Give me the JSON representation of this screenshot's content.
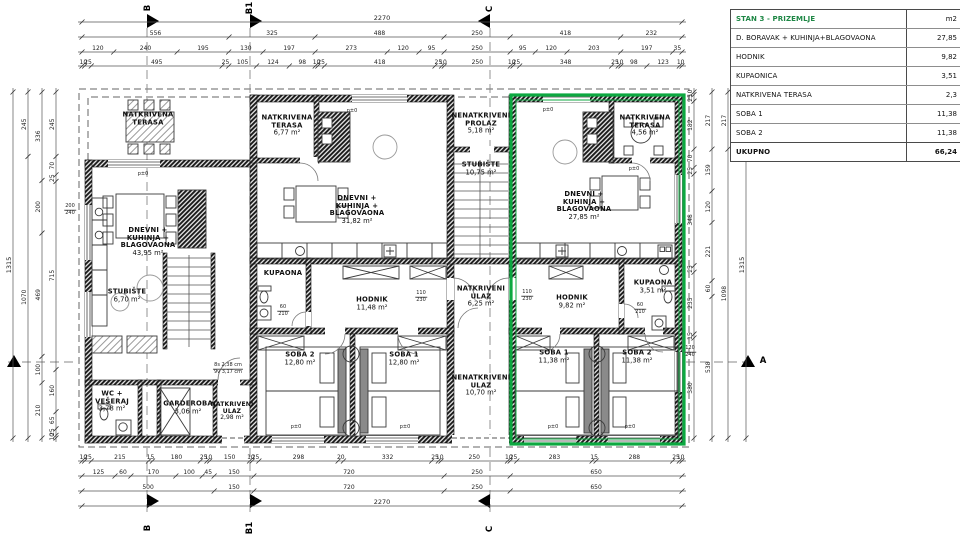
{
  "colors": {
    "highlight_green": "#0ca840",
    "table_title_green": "#1e8745",
    "wall": "#1c1c1c",
    "dim_line": "#555555"
  },
  "table": {
    "title": "STAN 3 - PRIZEMLJE",
    "unit_header": "m2",
    "rows": [
      {
        "label": "D. BORAVAK + KUHINJA+BLAGOVAONA",
        "value": "27,85"
      },
      {
        "label": "HODNIK",
        "value": "9,82"
      },
      {
        "label": "KUPAONICA",
        "value": "3,51"
      },
      {
        "label": "NATKRIVENA TERASA",
        "value": "2,3"
      },
      {
        "label": "SOBA 1",
        "value": "11,38"
      },
      {
        "label": "SOBA 2",
        "value": "11,38"
      }
    ],
    "total": {
      "label": "UKUPNO",
      "value": "66,24"
    }
  },
  "plan_labels": [
    {
      "k": "room",
      "name": "room-terasa-left",
      "x": 148,
      "y": 119,
      "lines": [
        "NATKRIVENA",
        "TERASA"
      ]
    },
    {
      "k": "room",
      "name": "room-terasa-mid",
      "x": 287,
      "y": 126,
      "lines": [
        "NATKRIVENA",
        "TERASA",
        "6,77 m²"
      ]
    },
    {
      "k": "room",
      "name": "room-nenatkriveni-prolaz",
      "x": 481,
      "y": 124,
      "lines": [
        "NENATKRIVENI",
        "PROLAZ",
        "5,18 m²"
      ]
    },
    {
      "k": "room",
      "name": "room-stubiste-central",
      "x": 481,
      "y": 169,
      "lines": [
        "STUBIŠTE",
        "10,75 m²"
      ]
    },
    {
      "k": "room",
      "name": "room-dnevni-mid",
      "x": 357,
      "y": 210,
      "lines": [
        "DNEVNI +",
        "KUHINJA +",
        "BLAGOVAONA",
        "31,82 m²"
      ]
    },
    {
      "k": "room",
      "name": "room-terasa-right",
      "x": 645,
      "y": 126,
      "lines": [
        "NATKRIVENA",
        "TERASA",
        "4,56 m²"
      ]
    },
    {
      "k": "room",
      "name": "room-dnevni-right",
      "x": 584,
      "y": 206,
      "lines": [
        "DNEVNI +",
        "KUHINJA +",
        "BLAGOVAONA",
        "27,85 m²"
      ]
    },
    {
      "k": "room",
      "name": "room-dnevni-left",
      "x": 148,
      "y": 242,
      "lines": [
        "DNEVNI +",
        "KUHINJA +",
        "BLAGOVAONA",
        "43,95 m²"
      ]
    },
    {
      "k": "room",
      "name": "room-stubiste-left",
      "x": 127,
      "y": 296,
      "lines": [
        "STUBIŠTE",
        "6,70 m²"
      ]
    },
    {
      "k": "room",
      "name": "room-kupaona-mid",
      "x": 283,
      "y": 274,
      "lines": [
        "KUPAONA"
      ]
    },
    {
      "k": "room",
      "name": "room-hodnik-mid",
      "x": 372,
      "y": 304,
      "lines": [
        "HODNIK",
        "11,48 m²"
      ]
    },
    {
      "k": "room",
      "name": "room-natkriveni-ulaz-central",
      "x": 481,
      "y": 297,
      "lines": [
        "NATKRIVENI",
        "ULAZ",
        "6,25 m²"
      ]
    },
    {
      "k": "room",
      "name": "room-hodnik-right",
      "x": 572,
      "y": 302,
      "lines": [
        "HODNIK",
        "9,82 m²"
      ]
    },
    {
      "k": "room",
      "name": "room-kupaona-right",
      "x": 653,
      "y": 287,
      "lines": [
        "KUPAONA",
        "3,51 m²"
      ]
    },
    {
      "k": "room",
      "name": "room-soba2-mid",
      "x": 300,
      "y": 359,
      "lines": [
        "SOBA 2",
        "12,80 m²"
      ]
    },
    {
      "k": "room",
      "name": "room-soba1-mid",
      "x": 404,
      "y": 359,
      "lines": [
        "SOBA 1",
        "12,80 m²"
      ]
    },
    {
      "k": "room",
      "name": "room-soba1-right",
      "x": 554,
      "y": 357,
      "lines": [
        "SOBA 1",
        "11,38 m²"
      ]
    },
    {
      "k": "room",
      "name": "room-soba2-right",
      "x": 637,
      "y": 357,
      "lines": [
        "SOBA 2",
        "11,38 m²"
      ]
    },
    {
      "k": "room",
      "name": "room-nenatkriveni-ulaz-central",
      "x": 481,
      "y": 386,
      "lines": [
        "NENATKRIVENI",
        "ULAZ",
        "10,70 m²"
      ]
    },
    {
      "k": "room",
      "name": "room-wc-veseraj",
      "x": 112,
      "y": 402,
      "lines": [
        "WC +",
        "VEŠERAJ",
        "3,78 m²"
      ]
    },
    {
      "k": "room",
      "name": "room-garderoba",
      "x": 188,
      "y": 408,
      "lines": [
        "GARDEROBA",
        "3,06 m²"
      ]
    },
    {
      "k": "room",
      "name": "room-natkriveni-ulaz-left",
      "x": 232,
      "y": 412,
      "size": 6,
      "lines": [
        "NATKRIVENI",
        "ULAZ",
        "2,98 m²"
      ]
    },
    {
      "k": "small",
      "name": "stair-note",
      "x": 228,
      "y": 369,
      "lines": [
        "8s 2,38 cm",
        "9v 3,17 cm"
      ]
    },
    {
      "k": "small",
      "name": "level-mark-1",
      "x": 143,
      "y": 175,
      "lines": [
        "p±0"
      ]
    },
    {
      "k": "small",
      "name": "level-mark-2",
      "x": 352,
      "y": 112,
      "lines": [
        "p±0"
      ]
    },
    {
      "k": "small",
      "name": "level-mark-3",
      "x": 548,
      "y": 111,
      "lines": [
        "p±0"
      ]
    },
    {
      "k": "small",
      "name": "level-mark-4",
      "x": 634,
      "y": 170,
      "lines": [
        "p±0"
      ]
    },
    {
      "k": "small",
      "name": "level-mark-5",
      "x": 296,
      "y": 428,
      "lines": [
        "p±0"
      ]
    },
    {
      "k": "small",
      "name": "level-mark-6",
      "x": 405,
      "y": 428,
      "lines": [
        "p±0"
      ]
    },
    {
      "k": "small",
      "name": "level-mark-7",
      "x": 553,
      "y": 428,
      "lines": [
        "p±0"
      ]
    },
    {
      "k": "small",
      "name": "level-mark-8",
      "x": 630,
      "y": 428,
      "lines": [
        "p±0"
      ]
    },
    {
      "k": "small",
      "name": "door-size-1",
      "x": 421,
      "y": 297,
      "lines": [
        "110",
        "230"
      ]
    },
    {
      "k": "small",
      "name": "door-size-2",
      "x": 527,
      "y": 296,
      "lines": [
        "110",
        "230"
      ]
    },
    {
      "k": "small",
      "name": "door-size-3",
      "x": 283,
      "y": 311,
      "lines": [
        "60",
        "210"
      ]
    },
    {
      "k": "small",
      "name": "door-size-4",
      "x": 640,
      "y": 309,
      "lines": [
        "60",
        "210"
      ]
    },
    {
      "k": "small",
      "name": "window-size-right",
      "x": 690,
      "y": 352,
      "lines": [
        "120",
        "240"
      ]
    },
    {
      "k": "small",
      "name": "window-size-left",
      "x": 70,
      "y": 210,
      "lines": [
        "200",
        "240"
      ]
    },
    {
      "k": "grid",
      "name": "grid-label-b-top",
      "x": 148,
      "y": 8,
      "rot": -90,
      "text": "B"
    },
    {
      "k": "grid",
      "name": "grid-label-b1-top",
      "x": 250,
      "y": 8,
      "rot": -90,
      "text": "B1"
    },
    {
      "k": "grid",
      "name": "grid-label-c-top",
      "x": 490,
      "y": 9,
      "rot": -90,
      "text": "C"
    },
    {
      "k": "grid",
      "name": "grid-label-b-bottom",
      "x": 148,
      "y": 528,
      "rot": -90,
      "text": "B"
    },
    {
      "k": "grid",
      "name": "grid-label-b1-bottom",
      "x": 250,
      "y": 528,
      "rot": -90,
      "text": "B1"
    },
    {
      "k": "grid",
      "name": "grid-label-c-bottom",
      "x": 490,
      "y": 529,
      "rot": -90,
      "text": "C"
    },
    {
      "k": "grid",
      "name": "grid-label-a-right",
      "x": 763,
      "y": 361,
      "text": "A"
    }
  ],
  "dims": {
    "top": {
      "x0": 82,
      "x1": 682,
      "rows": [
        {
          "y": 22,
          "values": [
            2270
          ]
        },
        {
          "y": 37,
          "values": [
            556,
            325,
            488,
            250,
            418,
            232
          ]
        },
        {
          "y": 52,
          "values": [
            120,
            240,
            195,
            130,
            197,
            273,
            120,
            95,
            250,
            95,
            120,
            203,
            197,
            35
          ]
        },
        {
          "y": 66,
          "values": [
            10,
            25,
            495,
            25,
            105,
            124,
            98,
            10,
            25,
            418,
            25,
            10,
            250,
            10,
            25,
            348,
            25,
            10,
            98,
            123,
            10
          ]
        }
      ]
    },
    "bottom": {
      "x0": 82,
      "x1": 682,
      "rows": [
        {
          "y": 461,
          "values": [
            10,
            25,
            215,
            15,
            180,
            25,
            10,
            150,
            10,
            25,
            298,
            20,
            332,
            25,
            10,
            250,
            10,
            25,
            283,
            15,
            288,
            25,
            10
          ]
        },
        {
          "y": 476,
          "values": [
            125,
            60,
            170,
            100,
            45,
            150,
            720,
            250,
            650
          ]
        },
        {
          "y": 491,
          "values": [
            500,
            150,
            720,
            250,
            650
          ]
        },
        {
          "y": 506,
          "values": [
            2270
          ]
        }
      ]
    },
    "left": {
      "y0": 92,
      "y1": 438,
      "cols": [
        {
          "x": 13,
          "values": [
            1315
          ]
        },
        {
          "x": 28,
          "values": [
            245,
            1070
          ]
        },
        {
          "x": 42,
          "values": [
            336,
            200,
            469,
            100,
            210
          ]
        },
        {
          "x": 56,
          "values": [
            245,
            70,
            25,
            715,
            160,
            65,
            25,
            10
          ]
        }
      ]
    },
    "right": {
      "y0": 92,
      "y1": 438,
      "cols": [
        {
          "x": 694,
          "values": [
            10,
            25,
            182,
            70,
            25,
            348,
            25,
            235,
            15,
            380
          ]
        },
        {
          "x": 712,
          "values": [
            217,
            159,
            120,
            221,
            60,
            538
          ]
        },
        {
          "x": 728,
          "values": [
            217,
            1098
          ]
        },
        {
          "x": 746,
          "values": [
            1315
          ]
        }
      ]
    }
  }
}
